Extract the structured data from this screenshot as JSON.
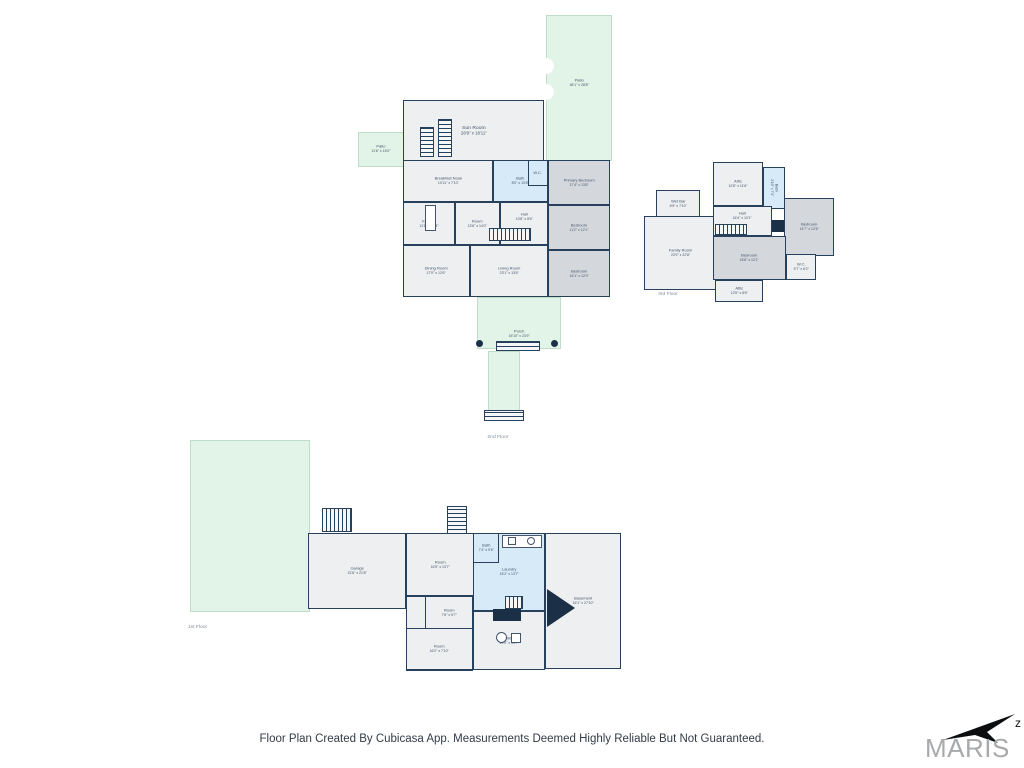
{
  "colors": {
    "wall": "#27415d",
    "room_light": "#edeff1",
    "room_gray": "#d4d8dc",
    "room_blue": "#d6ebf7",
    "outdoor_green": "#e2f3e7",
    "label_text": "#44546a",
    "logo_gray": "#a7a9ab"
  },
  "footer": {
    "disclaimer": "Floor Plan Created By Cubicasa App. Measurements Deemed Highly Reliable But Not Guaranteed."
  },
  "branding": {
    "logo_text": "MARIS",
    "compass_letter": "z"
  },
  "floor2": {
    "floor_label": "2nd Floor",
    "sun_room": {
      "name": "Sun Room",
      "dims": "28'9\" x 18'11\""
    },
    "breakfast_nook": {
      "name": "Breakfast Nook",
      "dims": "10'11\" x 7'10\""
    },
    "kitchen": {
      "name": "Kitchen",
      "dims": "11'1\" x 13'8\""
    },
    "room": {
      "name": "Room",
      "dims": "13'6\" x 14'0\""
    },
    "bath": {
      "name": "Bath",
      "dims": "8'0\" x 10'8\""
    },
    "wc": {
      "name": "W.C.",
      "dims": "3'5\" x 5'6\""
    },
    "hall": {
      "name": "Hall",
      "dims": "10'8\" x 8'6\""
    },
    "primary_bedroom": {
      "name": "Primary Bedroom",
      "dims": "17'4\" x 13'8\""
    },
    "bedroom_mid": {
      "name": "Bedroom",
      "dims": "11'2\" x 12'1\""
    },
    "bedroom_bottom": {
      "name": "Bedroom",
      "dims": "16'1\" x 12'0\""
    },
    "dining_room": {
      "name": "Dining Room",
      "dims": "17'0\" x 12'6\""
    },
    "living_room": {
      "name": "Living Room",
      "dims": "23'1\" x 13'6\""
    },
    "porch": {
      "name": "Porch",
      "dims": "15'10\" x 23'9\""
    },
    "patio_right": {
      "name": "Patio",
      "dims": "46'1\" x 28'8\""
    },
    "patio_left": {
      "name": "Patio",
      "dims": "11'6\" x 16'0\""
    }
  },
  "floor3": {
    "floor_label": "3rd Floor",
    "attic_top": {
      "name": "Attic",
      "dims": "12'8\" x 11'6\""
    },
    "bath": {
      "name": "Bath",
      "dims": "2'10\" x 7'4\""
    },
    "wet_bar": {
      "name": "Wet Bar",
      "dims": "6'9\" x 7'10\""
    },
    "hall": {
      "name": "Hall",
      "dims": "16'4\" x 10'1\""
    },
    "family_room": {
      "name": "Family Room",
      "dims": "23'9\" x 22'8\""
    },
    "bedroom_right": {
      "name": "Bedroom",
      "dims": "14'7\" x 12'6\""
    },
    "bedroom_bottom": {
      "name": "Bedroom",
      "dims": "15'8\" x 12'1\""
    },
    "wc": {
      "name": "W.C.",
      "dims": "5'7\" x 6'2\""
    },
    "attic_bottom": {
      "name": "Attic",
      "dims": "12'5\" x 8'6\""
    }
  },
  "floor1": {
    "floor_label": "1st Floor",
    "garage": {
      "name": "Garage",
      "dims": "21'8\" x 21'8\""
    },
    "room_top": {
      "name": "Room",
      "dims": "16'5\" x 13'7\""
    },
    "bath": {
      "name": "Bath",
      "dims": "7'4\" x 5'6\""
    },
    "laundry": {
      "name": "Laundry",
      "dims": "15'2\" x 13'7\""
    },
    "basement": {
      "name": "Basement",
      "dims": "16'1\" x 27'10\""
    },
    "room_small": {
      "name": "Room",
      "dims": "7'6\" x 5'7\""
    },
    "room_bottom": {
      "name": "Room",
      "dims": "16'2\" x 7'10\""
    },
    "utility": {
      "name": "Utility",
      "dims": "20'0\" x 13'7\""
    }
  }
}
